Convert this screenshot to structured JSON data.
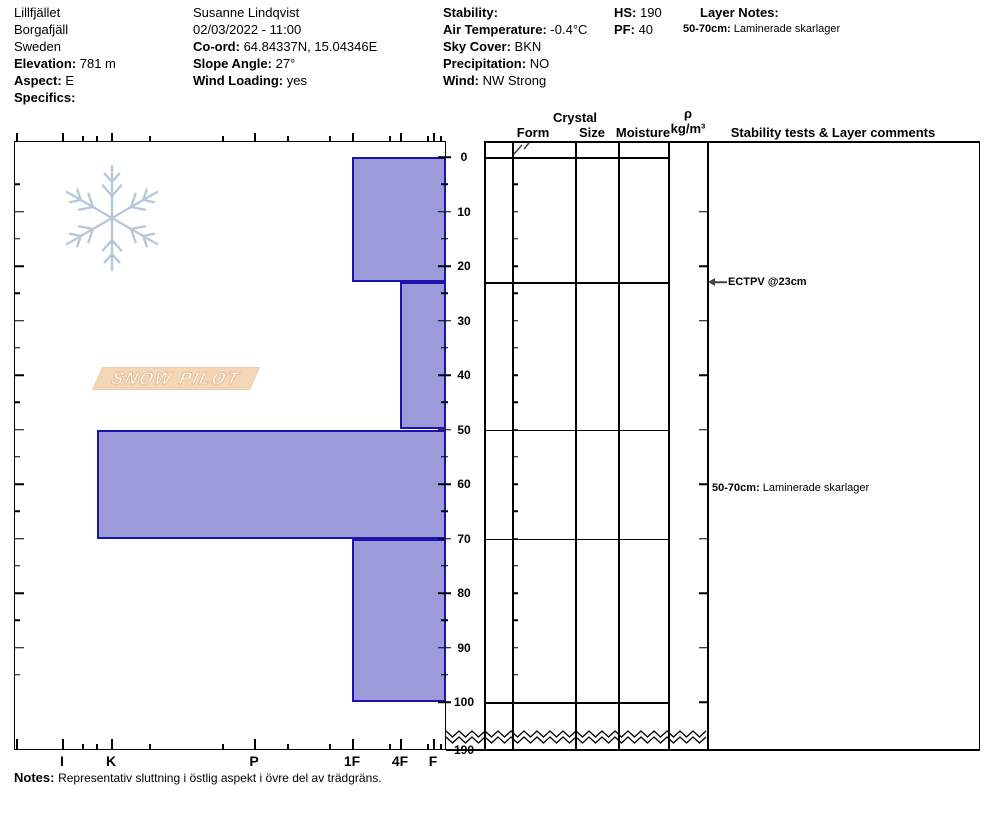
{
  "header": {
    "location": {
      "line1": "Lillfjället",
      "line2": "Borgafjäll",
      "line3": "Sweden",
      "elevation_label": "Elevation:",
      "elevation_value": "781 m",
      "aspect_label": "Aspect:",
      "aspect_value": "E",
      "specifics_label": "Specifics:",
      "specifics_value": ""
    },
    "observer": {
      "name": "Susanne Lindqvist",
      "datetime": "02/03/2022 - 11:00",
      "coord_label": "Co-ord:",
      "coord_value": "64.84337N, 15.04346E",
      "slope_label": "Slope Angle:",
      "slope_value": "27°",
      "wind_loading_label": "Wind Loading:",
      "wind_loading_value": "yes"
    },
    "conditions": {
      "stability_label": "Stability:",
      "stability_value": "",
      "air_temp_label": "Air Temperature:",
      "air_temp_value": "-0.4°C",
      "sky_label": "Sky Cover:",
      "sky_value": "BKN",
      "precip_label": "Precipitation:",
      "precip_value": "NO",
      "wind_label": "Wind:",
      "wind_value": "NW Strong"
    },
    "measures": {
      "hs_label": "HS:",
      "hs_value": "190",
      "pf_label": "PF:",
      "pf_value": "40"
    },
    "layer_notes": {
      "title": "Layer Notes:",
      "note_range": "50-70cm:",
      "note_text": "Laminerade skarlager"
    }
  },
  "logo": {
    "text": "SNOW PILOT",
    "banner_color": "#f4d6b6",
    "flake_color": "#b9c8d8"
  },
  "columns": {
    "crystal_group": "Crystal",
    "form": "Form",
    "size": "Size",
    "moisture": "Moisture",
    "rho": "ρ",
    "rho_unit": "kg/m³",
    "comments": "Stability tests & Layer comments"
  },
  "chart_data": {
    "type": "bar",
    "title": "Snow pit hardness profile (depth vs hand hardness)",
    "depth_axis": {
      "unit": "cm",
      "range": [
        0,
        100
      ],
      "tick_labels": [
        0,
        10,
        20,
        30,
        40,
        50,
        60,
        70,
        80,
        90,
        100
      ],
      "minor_step_cm": 5,
      "ground_label": "190",
      "break_symbol": "zigzag between 100 and 190"
    },
    "hardness_axis": {
      "tick_labels": [
        "I",
        "K",
        "P",
        "1F",
        "4F",
        "F"
      ],
      "orientation": "hard at left, soft at right"
    },
    "layers": [
      {
        "from_cm": 0,
        "to_cm": 23,
        "hardness": "1F"
      },
      {
        "from_cm": 23,
        "to_cm": 50,
        "hardness": "4F"
      },
      {
        "from_cm": 50,
        "to_cm": 70,
        "hardness": "K+"
      },
      {
        "from_cm": 70,
        "to_cm": 100,
        "hardness": "1F"
      }
    ],
    "bar_fill": "#9c9bd9",
    "bar_stroke": "#1c13ae",
    "surface_form_symbol": "two small slashes (grain form mark at surface layer)",
    "annotations": [
      {
        "text": "ECTPV @23cm",
        "depth_cm": 23,
        "arrow": "left"
      },
      {
        "bold": "50-70cm:",
        "text": "Laminerade skarlager",
        "depth_cm": 60
      }
    ]
  },
  "notes": {
    "label": "Notes:",
    "text": "Representativ sluttning i östlig aspekt i övre del av trädgräns."
  }
}
